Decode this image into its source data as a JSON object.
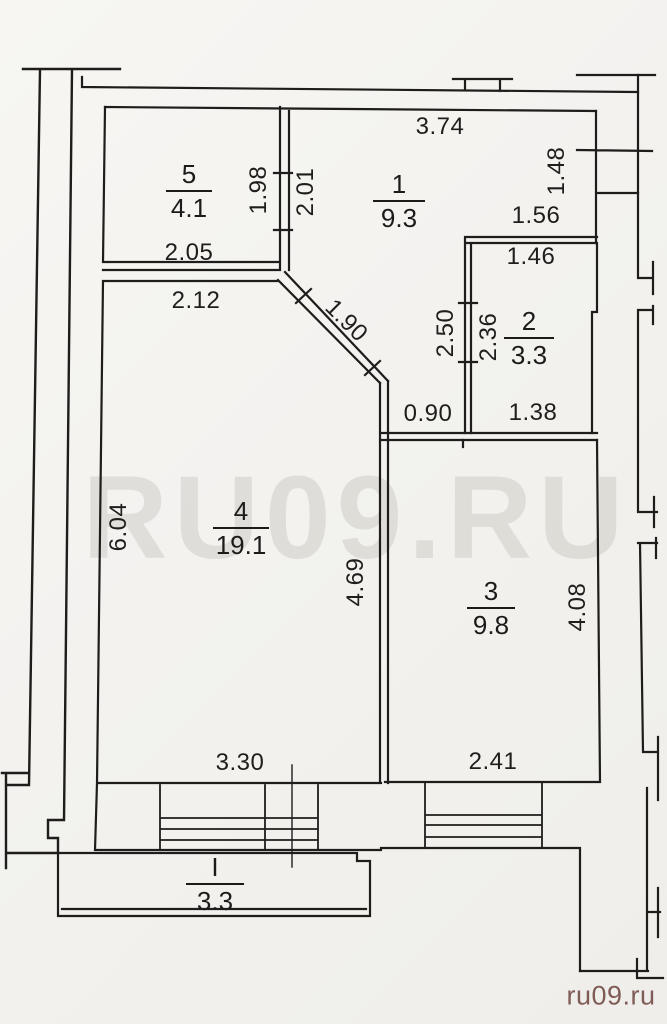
{
  "watermark": {
    "text": "RU09.RU"
  },
  "credit": {
    "text": "ru09.ru"
  },
  "colors": {
    "paper": "#f3f2ef",
    "line": "#1e1d1b",
    "credit_red": "#70483f"
  },
  "rooms": [
    {
      "id": "room-5",
      "number": "5",
      "area": "4.1"
    },
    {
      "id": "room-1",
      "number": "1",
      "area": "9.3"
    },
    {
      "id": "room-2",
      "number": "2",
      "area": "3.3"
    },
    {
      "id": "room-4",
      "number": "4",
      "area": "19.1"
    },
    {
      "id": "room-3",
      "number": "3",
      "area": "9.8"
    },
    {
      "id": "balcony",
      "number": "I",
      "area": "3.3"
    }
  ],
  "dimensions": [
    {
      "id": "dim-3-74",
      "value": "3.74",
      "orientation": "horizontal"
    },
    {
      "id": "dim-1-48",
      "value": "1.48",
      "orientation": "vertical"
    },
    {
      "id": "dim-1-98",
      "value": "1.98",
      "orientation": "vertical"
    },
    {
      "id": "dim-2-01",
      "value": "2.01",
      "orientation": "vertical"
    },
    {
      "id": "dim-1-56",
      "value": "1.56",
      "orientation": "horizontal"
    },
    {
      "id": "dim-1-46",
      "value": "1.46",
      "orientation": "horizontal"
    },
    {
      "id": "dim-2-05",
      "value": "2.05",
      "orientation": "horizontal"
    },
    {
      "id": "dim-2-12",
      "value": "2.12",
      "orientation": "horizontal"
    },
    {
      "id": "dim-1-90",
      "value": "1.90",
      "orientation": "diagonal"
    },
    {
      "id": "dim-2-50",
      "value": "2.50",
      "orientation": "vertical"
    },
    {
      "id": "dim-2-36",
      "value": "2.36",
      "orientation": "vertical"
    },
    {
      "id": "dim-0-90",
      "value": "0.90",
      "orientation": "horizontal"
    },
    {
      "id": "dim-1-38",
      "value": "1.38",
      "orientation": "horizontal"
    },
    {
      "id": "dim-6-04",
      "value": "6.04",
      "orientation": "vertical"
    },
    {
      "id": "dim-4-69",
      "value": "4.69",
      "orientation": "vertical"
    },
    {
      "id": "dim-4-08",
      "value": "4.08",
      "orientation": "vertical"
    },
    {
      "id": "dim-3-30",
      "value": "3.30",
      "orientation": "horizontal"
    },
    {
      "id": "dim-2-41",
      "value": "2.41",
      "orientation": "horizontal"
    }
  ]
}
